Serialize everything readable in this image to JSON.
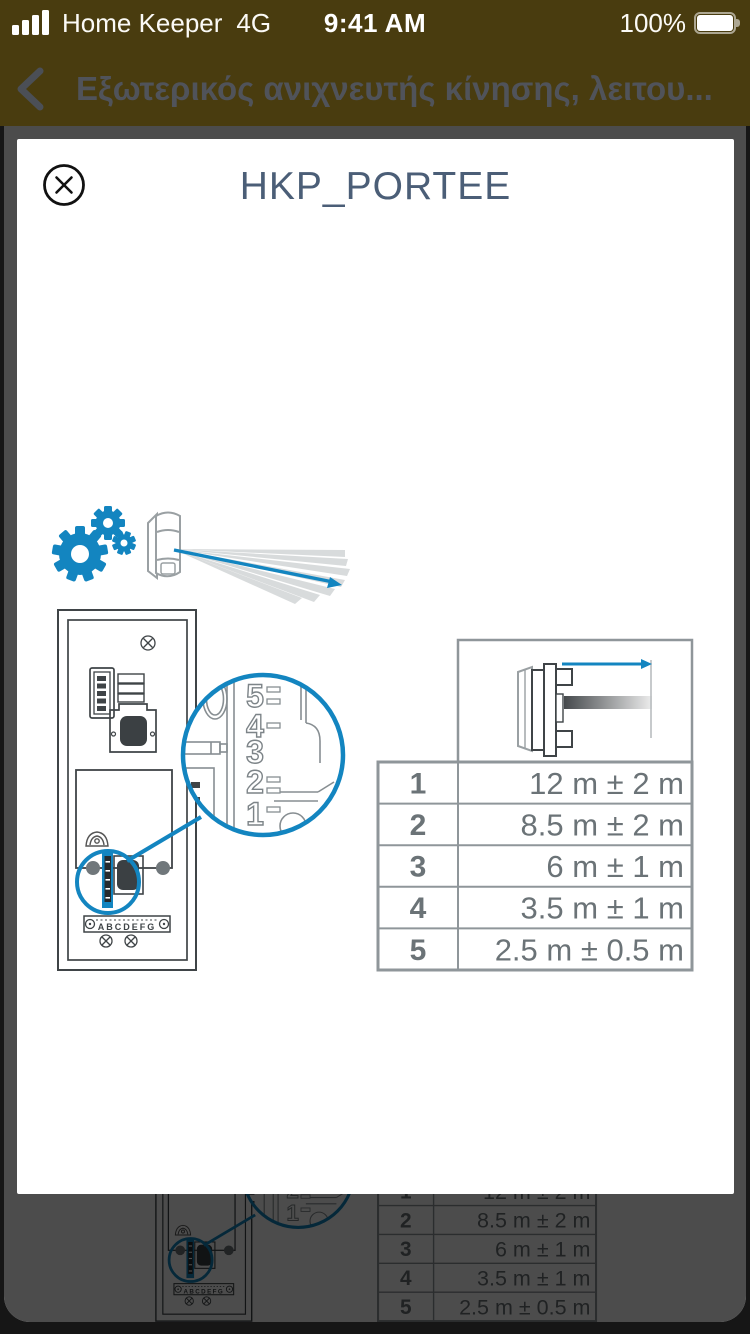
{
  "status_bar": {
    "carrier": "Home Keeper",
    "network": "4G",
    "time": "9:41 AM",
    "battery": "100%"
  },
  "nav_bar": {
    "title": "Εξωτερικός ανιχνευτής κίνησης, λειτου..."
  },
  "modal": {
    "title": "HKP_PORTEE"
  },
  "diagram": {
    "dial_numbers": [
      "5",
      "4",
      "3",
      "2",
      "1"
    ],
    "terminal_labels": "ABCDEFG",
    "range_table": {
      "rows": [
        {
          "level": "1",
          "range": "12 m ± 2 m"
        },
        {
          "level": "2",
          "range": "8.5 m ± 2 m"
        },
        {
          "level": "3",
          "range": "6 m ± 1 m"
        },
        {
          "level": "4",
          "range": "3.5 m ± 1 m"
        },
        {
          "level": "5",
          "range": "2.5 m ± 0.5 m"
        }
      ]
    }
  },
  "colors": {
    "accent_blue": "#1385c0",
    "header_olive": "#493c0f",
    "title_slate": "#4b5e77",
    "table_gray": "#6b7377",
    "backdrop_dim": "#4b4b4b"
  }
}
